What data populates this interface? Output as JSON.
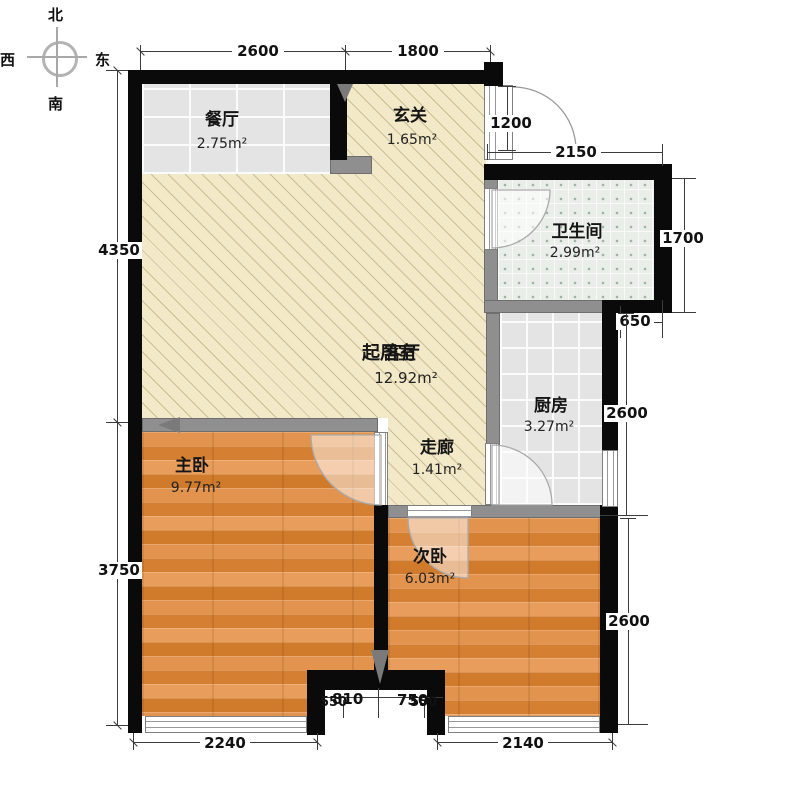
{
  "compass": {
    "north": "北",
    "west": "西",
    "east": "东",
    "south": "南"
  },
  "rooms": {
    "dining": {
      "name": "餐厅",
      "area": "2.75m²"
    },
    "entry": {
      "name": "玄关",
      "area": "1.65m²"
    },
    "bath": {
      "name": "卫生间",
      "area": "2.99m²"
    },
    "living": {
      "name_a": "起居室",
      "name_b": "客厅",
      "area": "12.92m²"
    },
    "kitchen": {
      "name": "厨房",
      "area": "3.27m²"
    },
    "corridor": {
      "name": "走廊",
      "area": "1.41m²"
    },
    "master": {
      "name": "主卧",
      "area": "9.77m²"
    },
    "second": {
      "name": "次卧",
      "area": "6.03m²"
    }
  },
  "dims": {
    "top_left": "2600",
    "top_right": "1800",
    "left_upper": "4350",
    "left_lower": "3750",
    "entry_door": "1200",
    "bath_top": "2150",
    "bath_right": "1700",
    "jog": "650",
    "right_upper": "2600",
    "right_lower": "2600",
    "bottom_left": "2240",
    "bottom_right": "2140",
    "notch_left_a": "550",
    "notch_left_b": "810",
    "notch_right_a": "750",
    "notch_right_b": "550"
  },
  "colors": {
    "wall": "#0a0a0a",
    "gray_wall": "#8f8f8f",
    "cream": "#f2e9c8",
    "wood": "#dd8a41",
    "tile": "#e4e4e4",
    "bath": "#e9efe8"
  }
}
